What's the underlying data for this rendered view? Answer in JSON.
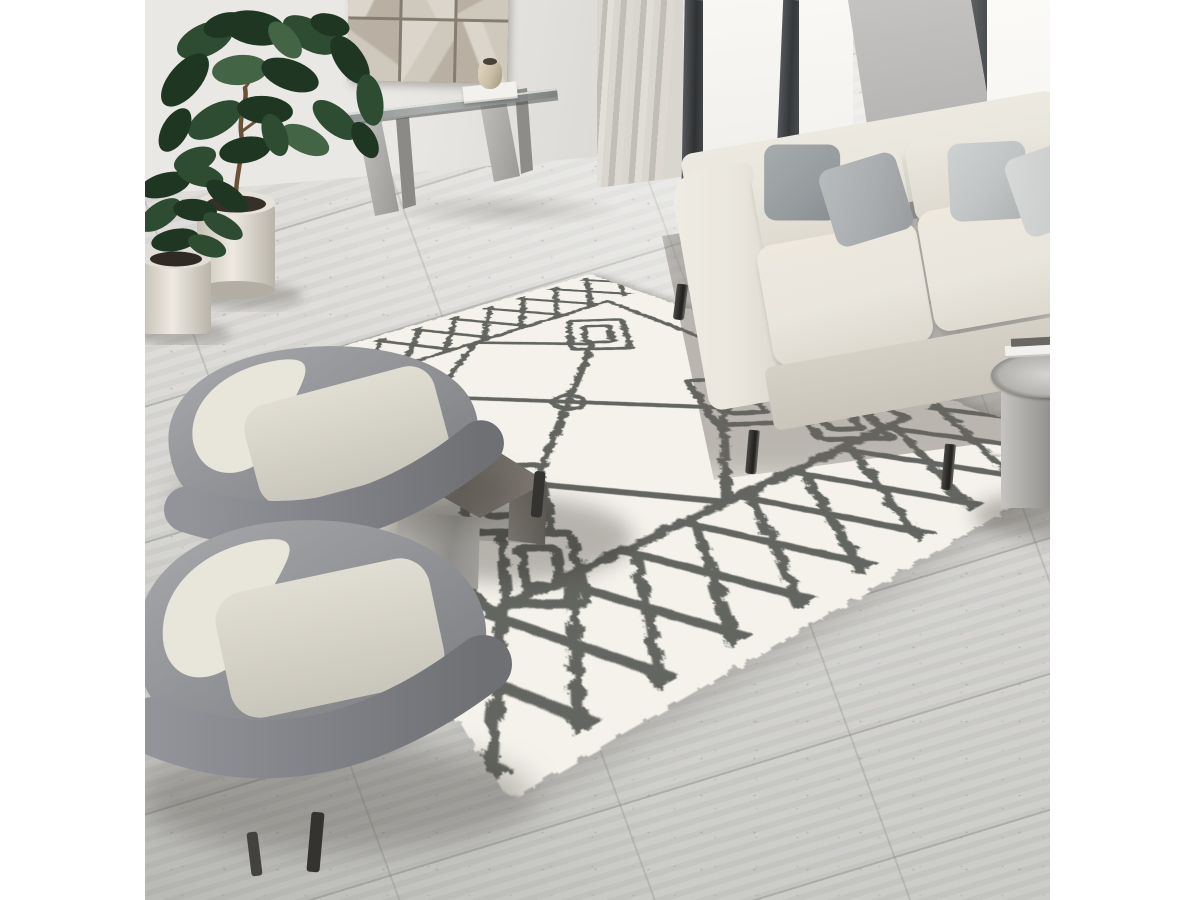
{
  "meta": {
    "type": "interior-photograph",
    "description": "Bright modern living room viewed from above: cream Moroccan-style shag rug with charcoal diamond lattice pattern, beige three-seat sofa with grey throw pillows, two grey velvet accent chairs with cream cushions, smoked-glass chrome cube coffee table with ceramic vase, glass console table under geometric relief wall art, fiddle-leaf fig and small potted plant, floor-to-ceiling windows with sheer curtain, grey travertine tile floor, white vertical letterbox bars left and right",
    "canvas": {
      "width": 1200,
      "height": 900
    },
    "photo_region": {
      "left": 145,
      "width": 905
    }
  },
  "scene": {
    "colors": {
      "wall": "#eae8e5",
      "wall-shade": "#dcdad6",
      "floor": "#dcdbd8",
      "floor-dark": "#c8c8c5",
      "grout": "#a9a9a5",
      "window-light": "#faf9f6",
      "frame-dark": "#3d3f41",
      "panel-grey": "#b7b5b3",
      "curtain": "#d9d6cf",
      "curtain-dark": "#c1beb7",
      "rug-base": "#f4f2eb",
      "rug-pattern": "#575954",
      "sofa-body": "#e9e6dd",
      "sofa-shade": "#d5d1c7",
      "pillow-dark": "#979c9f",
      "pillow-mid": "#a9adaf",
      "pillow-silver": "#c1c4c4",
      "pillow-pale": "#cbcdcc",
      "chair-shell": "#9b9ca0",
      "chair-shell-dark": "#77787c",
      "chair-cushion": "#e8e5da",
      "chair-seat": "#d7d4ca",
      "table-steel": "#b5b3af",
      "table-smoke": "#756f68",
      "leg-dark": "#34332f",
      "pot-cream": "#ddd9d0",
      "leaf-dark": "#1e3622",
      "leaf-mid": "#2e4c31",
      "leaf-light": "#436546",
      "trunk": "#6b5138",
      "art-beige": "#cfc8bc",
      "art-taupe": "#b9b0a3",
      "art-light": "#dbd5cb",
      "art-seam": "#857d70",
      "vase-cream": "#d8d3c9",
      "vase-tan": "#c9bda6",
      "book-white": "#f2f1ee"
    },
    "objects": [
      {
        "name": "moroccan-shag-rug",
        "label": "Cream shag rug with charcoal Berber diamond pattern"
      },
      {
        "name": "sofa",
        "label": "Beige fabric 3-seat sofa, four grey pillows, black tapered legs"
      },
      {
        "name": "armchair-back",
        "label": "Grey velvet accent chair with cream cushion"
      },
      {
        "name": "armchair-front",
        "label": "Grey velvet accent chair with cream cushion"
      },
      {
        "name": "coffee-table",
        "label": "Smoked glass and steel cube coffee table"
      },
      {
        "name": "coffee-table-vase",
        "label": "Cream ceramic vase"
      },
      {
        "name": "console-table",
        "label": "Glass-top console with steel legs, book and small vase"
      },
      {
        "name": "wall-art",
        "label": "Geometric beige relief panels"
      },
      {
        "name": "fiddle-leaf-fig",
        "label": "Fiddle-leaf fig in cream cylinder pot"
      },
      {
        "name": "small-plant",
        "label": "Small leafy plant in cream pot"
      },
      {
        "name": "side-table",
        "label": "Round steel drum side table with books"
      },
      {
        "name": "windows",
        "label": "Floor-to-ceiling windows, dark frames, sheer curtain"
      },
      {
        "name": "floor",
        "label": "Grey travertine tile floor"
      }
    ]
  }
}
